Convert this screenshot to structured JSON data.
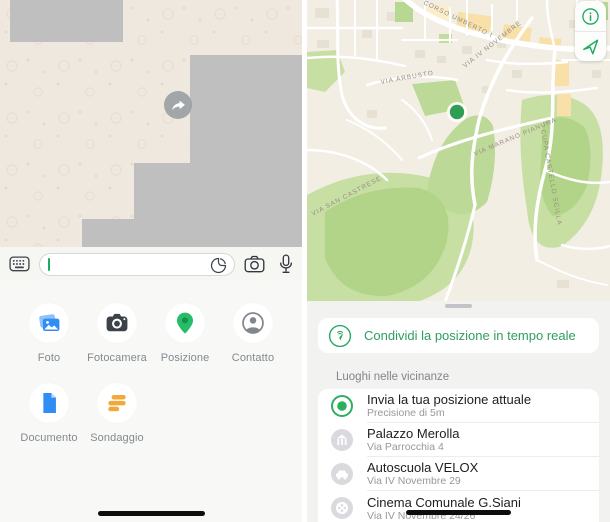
{
  "app": "WhatsApp",
  "colors": {
    "accent_green": "#1daa61",
    "live_share_text": "#2f9e5e",
    "chat_wallpaper": "#efe8de",
    "redaction_gray": "#bfbfbf",
    "poll_orange": "#f2a93b",
    "photo_blue": "#2f8df6",
    "map_park_green": "#c8dfa4",
    "marker_green": "#2e9e52"
  },
  "left": {
    "chat": {
      "share_button_icon": "forward-arrow-icon"
    },
    "composer": {
      "value": "",
      "placeholder": "",
      "icons": [
        "keyboard-icon",
        "sticker-icon",
        "camera-icon",
        "microphone-icon"
      ]
    },
    "attachments": {
      "items": [
        {
          "label": "Foto",
          "icon": "photos-icon"
        },
        {
          "label": "Fotocamera",
          "icon": "camera-filled-icon"
        },
        {
          "label": "Posizione",
          "icon": "location-pin-icon"
        },
        {
          "label": "Contatto",
          "icon": "contact-icon"
        },
        {
          "label": "Documento",
          "icon": "document-icon"
        },
        {
          "label": "Sondaggio",
          "icon": "poll-icon"
        }
      ]
    }
  },
  "right": {
    "map": {
      "buttons": [
        {
          "icon": "info-icon"
        },
        {
          "icon": "navigation-arrow-icon"
        }
      ],
      "marker": "current-position-dot",
      "labels": {
        "corso": "CORSO UMBERTO I",
        "iv_novembre": "VIA IV NOVEMBRE",
        "arbusto": "VIA ARBUSTO",
        "marano": "VIA MARANO PIANURA",
        "san_castrese": "VIA SAN CASTRESE",
        "castello": "CUPA CASTELLO SCILLA"
      }
    },
    "sheet": {
      "live_share_label": "Condividi la posizione in tempo reale",
      "section_header": "Luoghi nelle vicinanze",
      "places": [
        {
          "title": "Invia la tua posizione attuale",
          "subtitle": "Precisione di 5m",
          "icon": "current-location-icon"
        },
        {
          "title": "Palazzo Merolla",
          "subtitle": "Via Parrocchia 4",
          "icon": "building-icon"
        },
        {
          "title": "Autoscuola VELOX",
          "subtitle": "Via IV Novembre 29",
          "icon": "car-icon"
        },
        {
          "title": "Cinema Comunale G.Siani",
          "subtitle": "Via IV Novembre 24/26",
          "icon": "film-reel-icon"
        }
      ]
    }
  }
}
